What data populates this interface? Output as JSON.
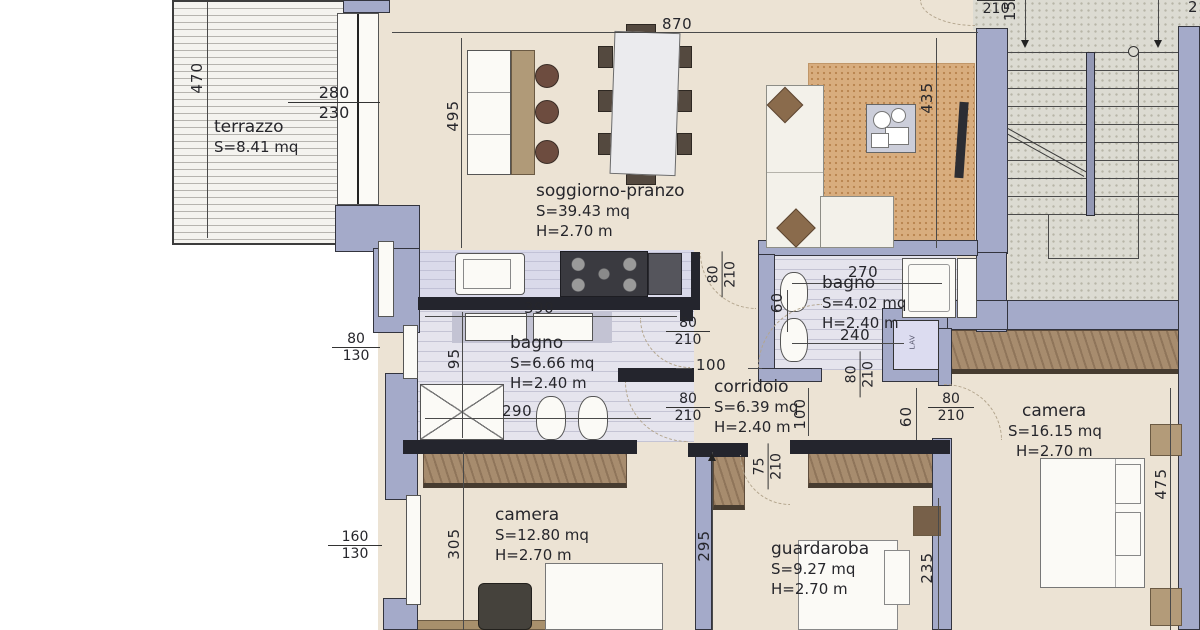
{
  "rooms": {
    "terrazzo": {
      "name": "terrazzo",
      "area": "S=8.41 mq"
    },
    "soggiorno": {
      "name": "soggiorno-pranzo",
      "area": "S=39.43 mq",
      "height": "H=2.70 m"
    },
    "bagno_grande": {
      "name": "bagno",
      "area": "S=6.66 mq",
      "height": "H=2.40 m"
    },
    "bagno_piccolo": {
      "name": "bagno",
      "area": "S=4.02 mq",
      "height": "H=2.40 m"
    },
    "corridoio": {
      "name": "corridoio",
      "area": "S=6.39 mq",
      "height": "H=2.40 m"
    },
    "camera_grande": {
      "name": "camera",
      "area": "S=16.15 mq",
      "height": "H=2.70 m"
    },
    "camera_piccola": {
      "name": "camera",
      "area": "S=12.80 mq",
      "height": "H=2.70 m"
    },
    "guardaroba": {
      "name": "guardaroba",
      "area": "S=9.27 mq",
      "height": "H=2.70 m"
    }
  },
  "dimensions": {
    "overall_top": "870",
    "terrace_depth": "470",
    "living_left": "495",
    "living_right": "435",
    "stair_door_den": "210",
    "stair_side": "15",
    "stair_fragment": "2",
    "kitchen_width": "390",
    "bath_big_depth": "95",
    "bath_big_inner": "290",
    "corridor_gap": "100",
    "corridor_height": "100",
    "bath_small_top": "270",
    "bath_small_side": "60",
    "bath_small_mid": "240",
    "niche_side": "60",
    "camera_small_depth": "305",
    "rooms_depth": "295",
    "wardrobe_depth": "235",
    "camera_big_depth": "475"
  },
  "openings": {
    "terrace_door": {
      "num": "280",
      "den": "230"
    },
    "door_80_210": {
      "num": "80",
      "den": "210"
    },
    "door_75_210": {
      "num": "75",
      "den": "210"
    },
    "window_80_130": {
      "num": "80",
      "den": "130"
    },
    "window_160_130": {
      "num": "160",
      "den": "130"
    }
  },
  "appliances": {
    "washer_label": "LAV"
  },
  "colors": {
    "wall_fill": "#a4aac9",
    "wall_dark": "#24252d",
    "floor": "#ece3d4",
    "terrace": "#f3f2ee",
    "bath_floor": "#e5e4ed",
    "counter": "#dadaea",
    "stairs": "#dcdbd2",
    "rug": "#d8ad7e",
    "wardrobe": "#9d8266",
    "wood": "#a8906c"
  }
}
